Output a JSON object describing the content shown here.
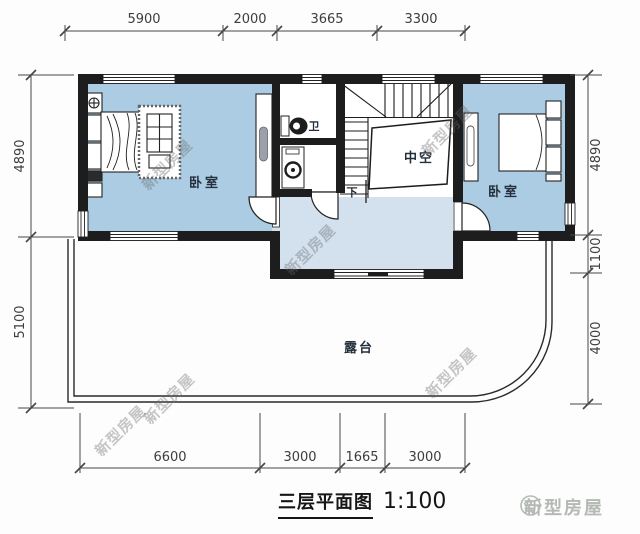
{
  "plan": {
    "caption": {
      "title": "三层平面图",
      "scale": "1:100"
    },
    "logo": {
      "name": "新型房屋"
    },
    "watermark_text": "新型房屋",
    "labels": {
      "bedroom_left": "卧室",
      "bedroom_right": "卧室",
      "bathroom": "卫",
      "void": "中空",
      "down": "下",
      "terrace": "露台"
    },
    "dimensions": {
      "top": [
        "5900",
        "2000",
        "3665",
        "3300"
      ],
      "bottom": [
        "6600",
        "3000",
        "1665",
        "3000"
      ],
      "left": [
        "4890",
        "5100"
      ],
      "right": [
        "4890",
        "1100",
        "4000"
      ]
    },
    "colors": {
      "room_fill": "#abcce3",
      "hall_fill": "#d3e1ef",
      "wall": "#1d1d1d",
      "terrace_line": "#2a2a2a",
      "logo": "#b4b9b4"
    }
  }
}
